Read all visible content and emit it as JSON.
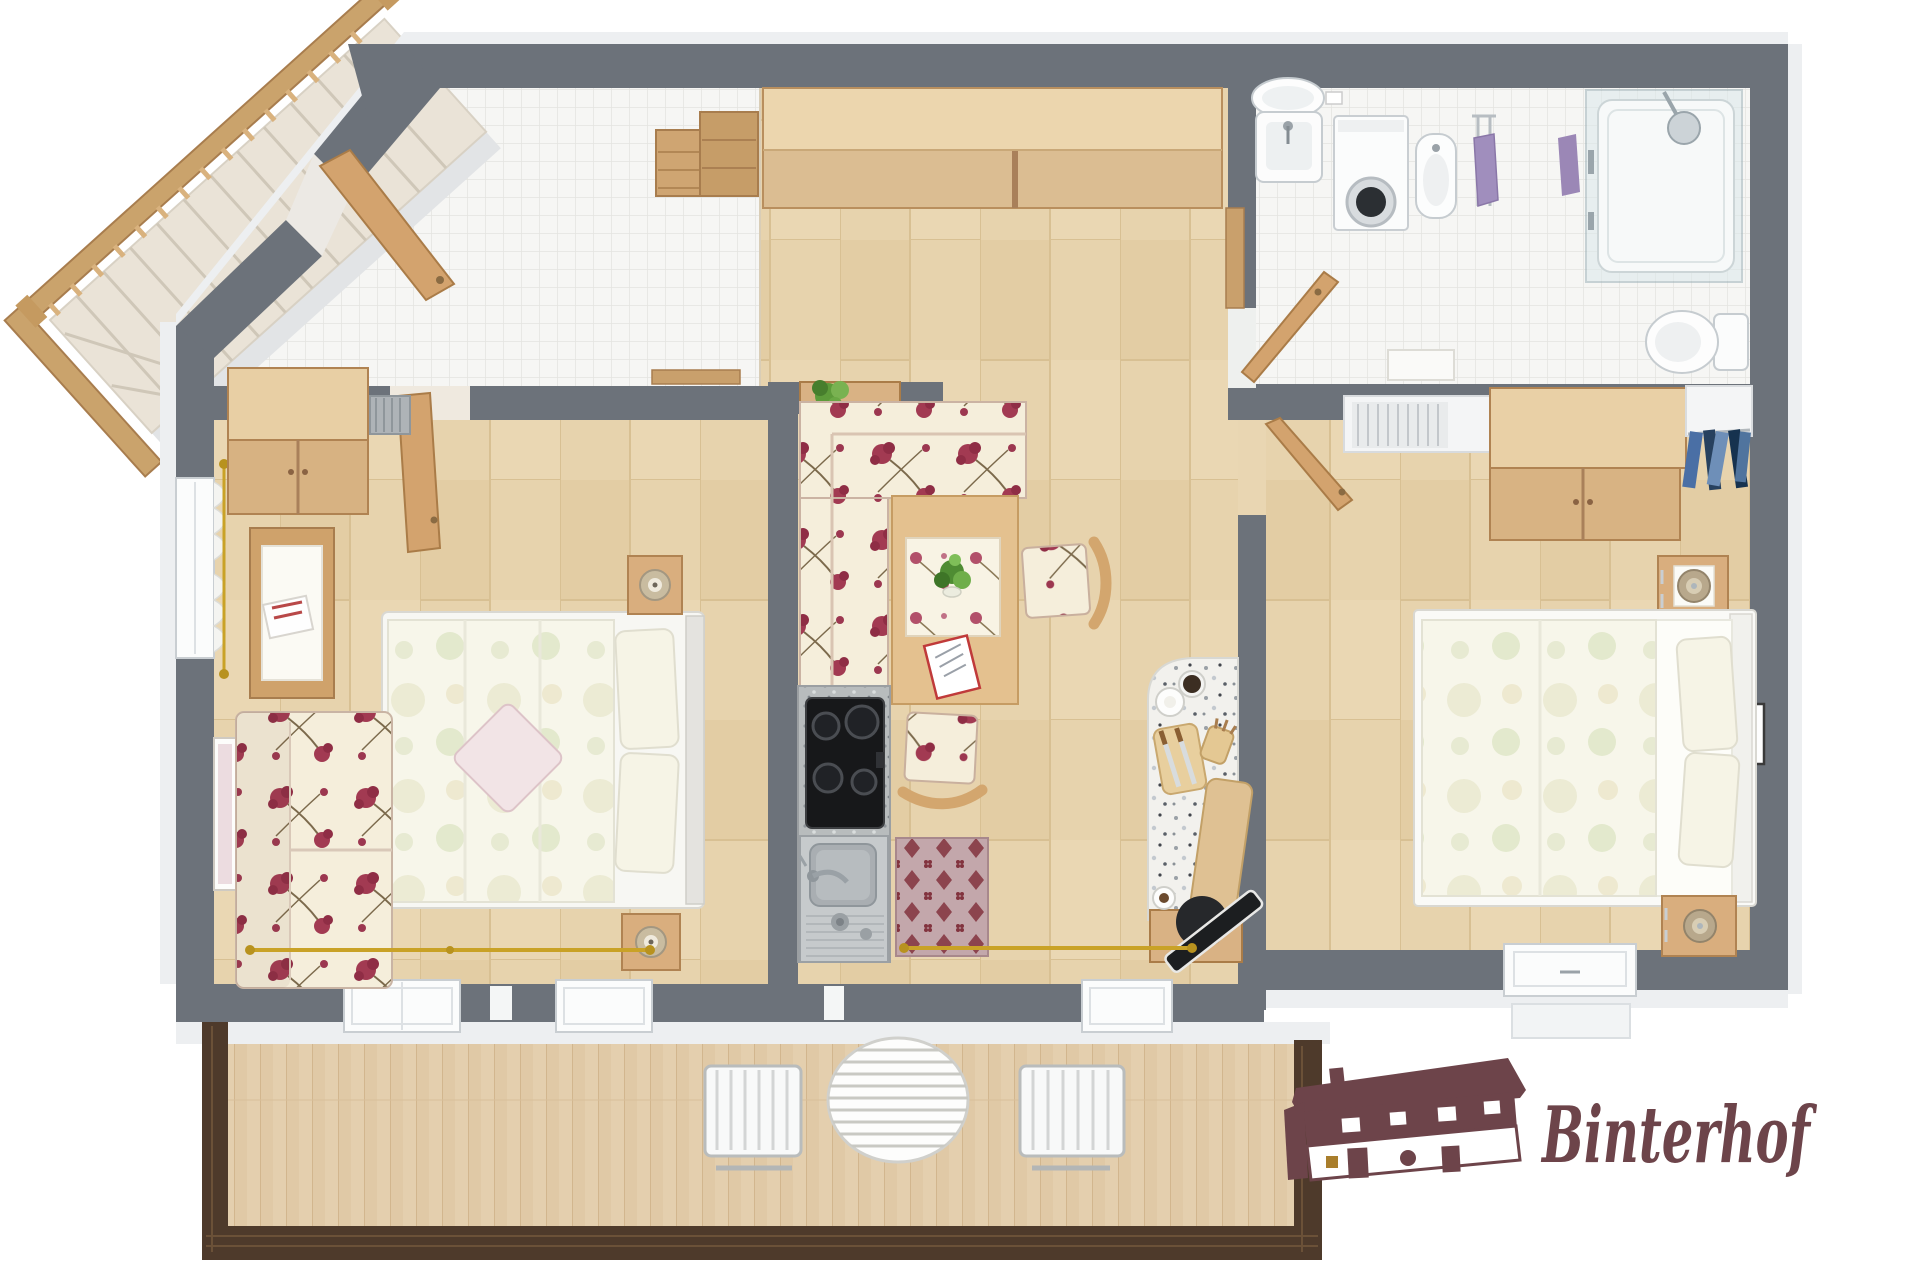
{
  "canvas": {
    "width": 1920,
    "height": 1280,
    "background": "#ffffff"
  },
  "palette": {
    "wall": "#6c727a",
    "wall_outer": "#edeff1",
    "wood_floor": "#e7d3ad",
    "tile": "#f6f6f4",
    "furniture_wood": "#d9b284",
    "floral_rose": "#a23a52",
    "bedding": "#f7f6ea",
    "balcony_rail": "#4e3a2b",
    "counter_speckle": "#b8bcbd",
    "terrazzo": "#f2f1ed",
    "gold": "#c9a227",
    "chrome": "#aeb6bb",
    "logo": "#6d444a"
  },
  "logo": {
    "text": "Binterhof",
    "icon": "farmhouse-icon",
    "color": "#6d444a"
  },
  "rooms": [
    {
      "id": "staircase",
      "floor": "none",
      "items": [
        "wooden-railing",
        "balusters",
        "winder-steps"
      ]
    },
    {
      "id": "entry-hall",
      "floor": "tile",
      "items": [
        "entrance-door",
        "drawer-chest",
        "shoe-rack"
      ]
    },
    {
      "id": "hallway",
      "floor": "wood",
      "items": [
        "double-wardrobe",
        "plant-shelf",
        "potted-plant",
        "wood-trim"
      ]
    },
    {
      "id": "bathroom",
      "floor": "tile",
      "items": [
        "pedestal-sink",
        "wall-switch",
        "washing-machine",
        "bidet",
        "towel-rail",
        "purple-towel",
        "purple-towel",
        "shower-enclosure",
        "shower-head",
        "toilet",
        "flush-plate",
        "bath-mat",
        "bathroom-door"
      ]
    },
    {
      "id": "bedroom-left",
      "floor": "wood",
      "items": [
        "wardrobe",
        "radiator",
        "room-door",
        "double-bed",
        "floral-pillows",
        "diagonal-cushion",
        "nightstand-with-lamp",
        "nightstand-with-lamp",
        "floral-sofa",
        "side-table-with-magazines",
        "wall-picture",
        "window-with-lace-curtains",
        "gold-curtain-rod"
      ]
    },
    {
      "id": "living-dining",
      "floor": "wood",
      "items": [
        "corner-bench-floral",
        "dining-table",
        "floral-table-runner",
        "potted-plant",
        "magazine",
        "dining-chair",
        "dining-chair",
        "kitchen-counter",
        "cooktop",
        "kitchen-sink",
        "patterned-rug",
        "bar-counter",
        "coffee-mug",
        "coffee-cup",
        "cutting-board-with-knives",
        "utensil-cup",
        "serving-board",
        "tv-lowboard",
        "tv-on-stand",
        "coffee-cup",
        "gold-curtain-rod"
      ]
    },
    {
      "id": "bedroom-right",
      "floor": "wood",
      "items": [
        "room-door",
        "radiator-alcove",
        "wardrobe",
        "open-closet-with-clothes",
        "nightstand-with-lamp",
        "double-bed",
        "floral-pillows",
        "nightstand-with-lamp",
        "wall-picture",
        "window"
      ]
    },
    {
      "id": "balcony",
      "floor": "deck",
      "items": [
        "dark-wood-railing",
        "round-slatted-table",
        "slatted-chair",
        "slatted-chair",
        "french-window",
        "french-window",
        "french-window"
      ]
    }
  ]
}
